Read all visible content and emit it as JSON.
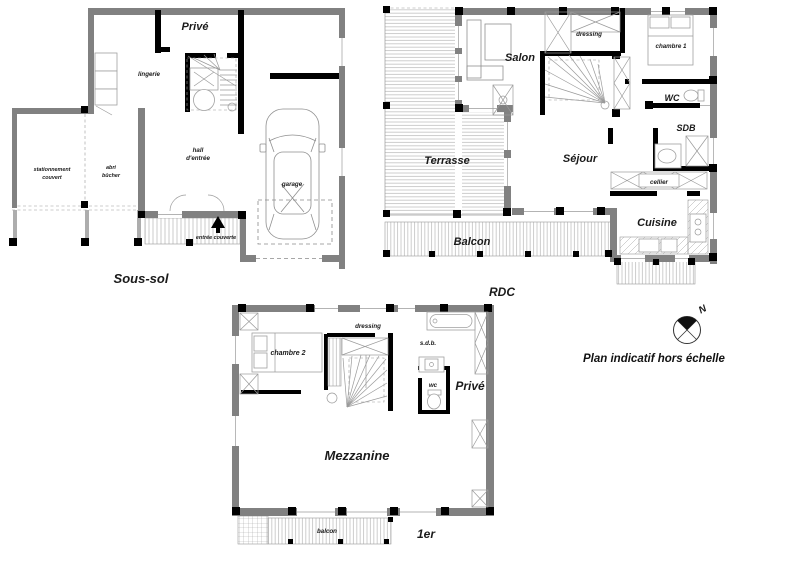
{
  "plans": {
    "sous_sol": {
      "title": "Sous-sol",
      "rooms": {
        "prive": "Privé",
        "lingerie": "lingerie",
        "hall_line1": "hall",
        "hall_line2": "d'entrée",
        "stationnement_line1": "stationnement",
        "stationnement_line2": "couvert",
        "abri_line1": "abri",
        "abri_line2": "bûcher",
        "garage": "garage",
        "entree_couverte": "entrée couverte"
      }
    },
    "rdc": {
      "title": "RDC",
      "rooms": {
        "salon": "Salon",
        "terrasse": "Terrasse",
        "sejour": "Séjour",
        "dressing": "dressing",
        "chambre1": "chambre 1",
        "wc": "WC",
        "sdb": "SDB",
        "cellier": "cellier",
        "cuisine": "Cuisine",
        "balcon": "Balcon"
      }
    },
    "premier": {
      "title": "1er",
      "rooms": {
        "chambre2": "chambre 2",
        "dressing": "dressing",
        "sdb": "s.d.b.",
        "wc": "wc",
        "prive": "Privé",
        "mezzanine": "Mezzanine",
        "balcon": "balcon"
      }
    }
  },
  "compass": {
    "north_label": "N"
  },
  "note": "Plan indicatif hors échelle",
  "colors": {
    "wall_gray": "#818181",
    "wall_black": "#000000",
    "hatch_line": "#b5b5b5",
    "background": "#ffffff"
  }
}
